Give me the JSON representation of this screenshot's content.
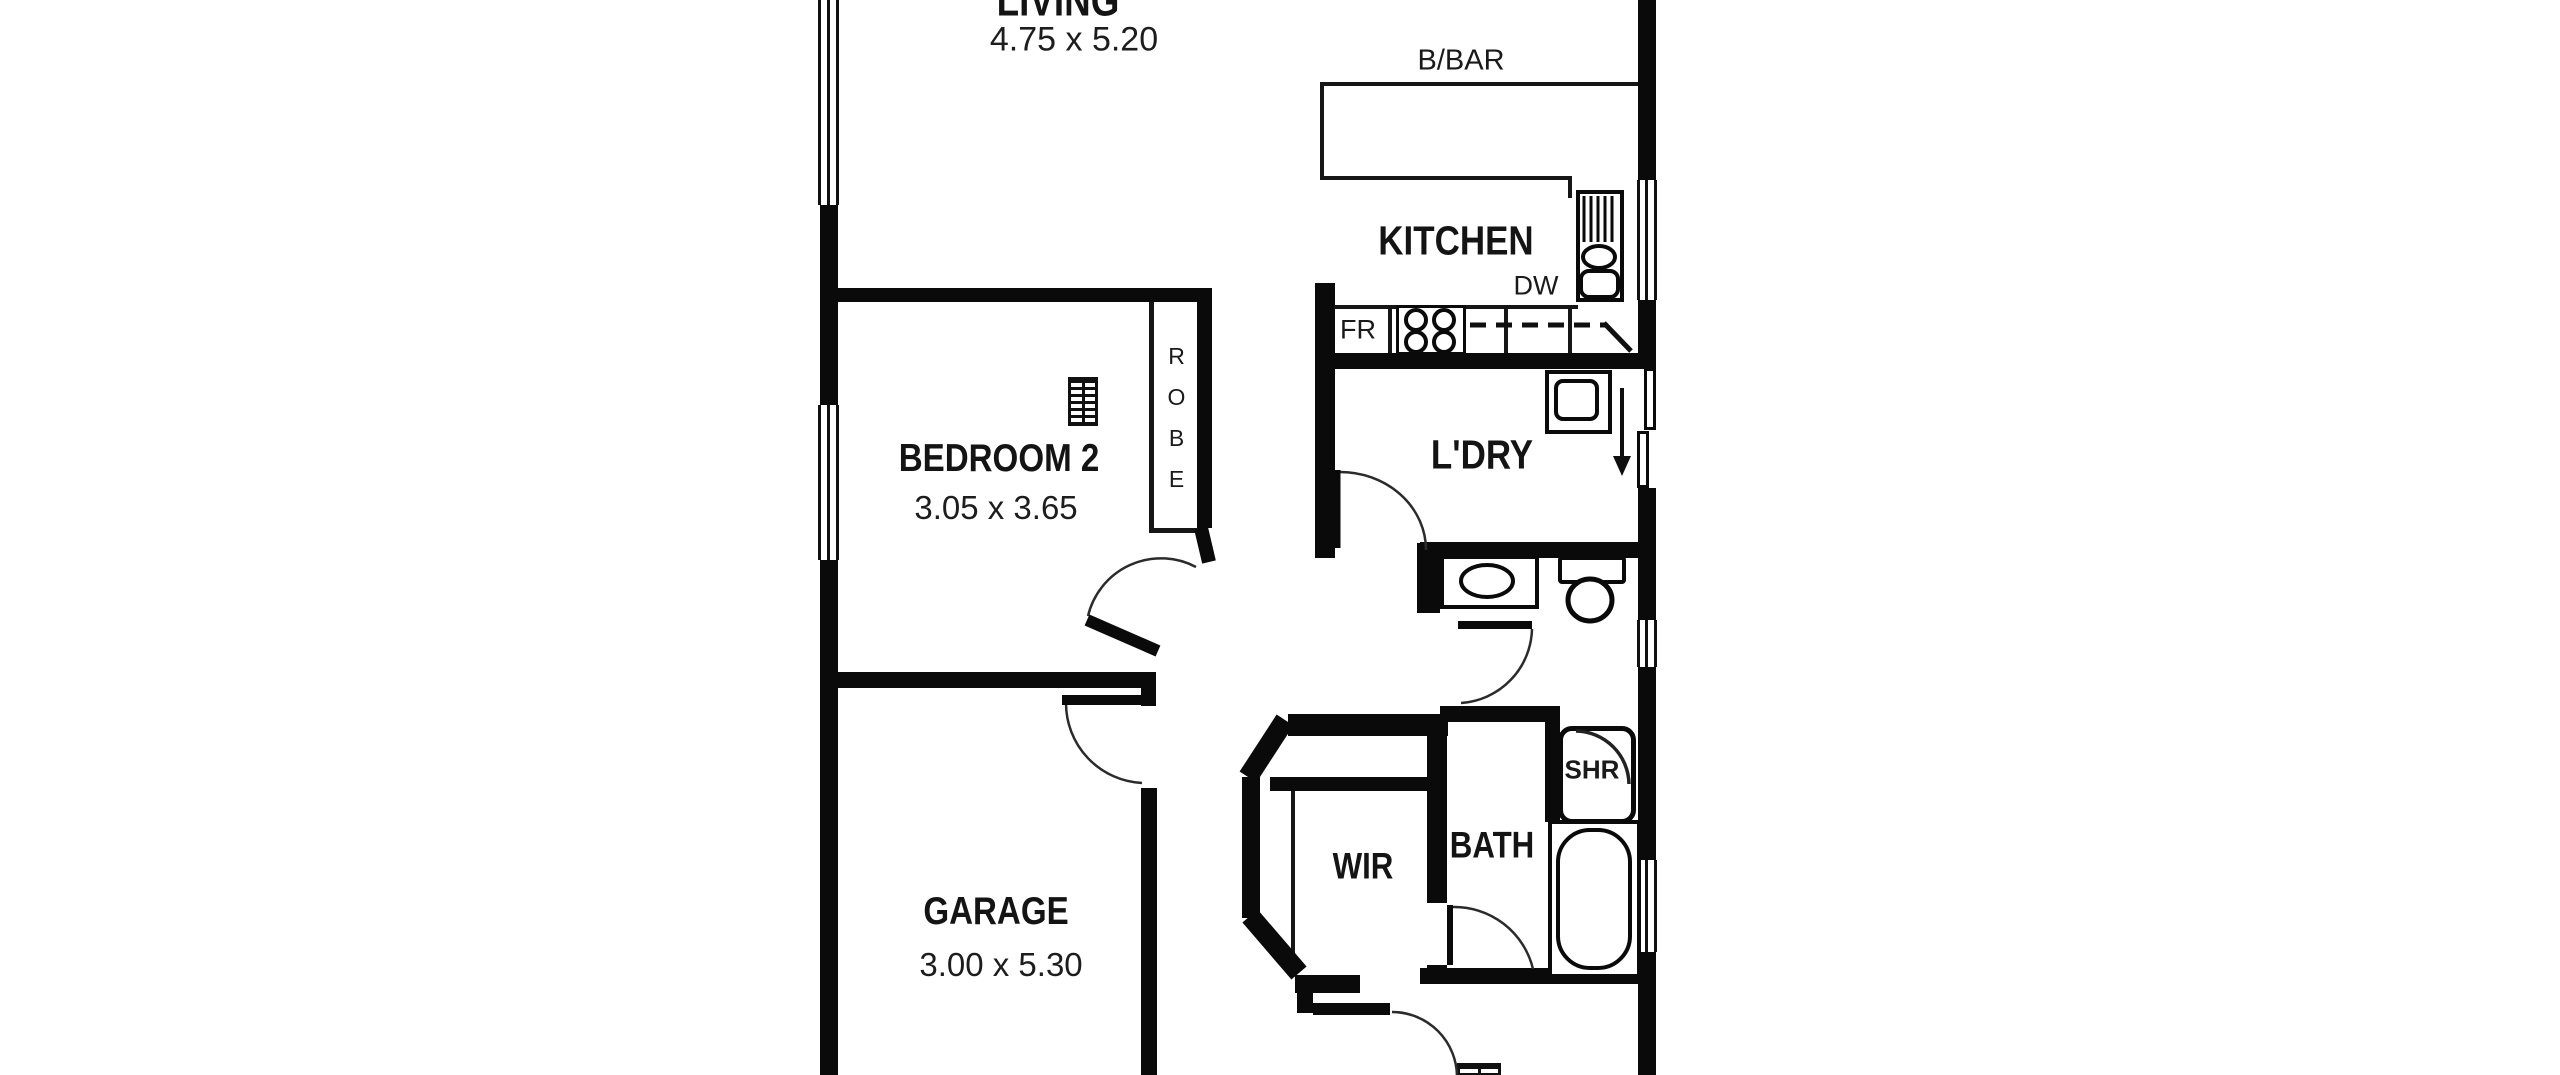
{
  "rooms": {
    "living": {
      "name": "LIVING",
      "dims": "4.75 x 5.20"
    },
    "kitchen": {
      "name": "KITCHEN"
    },
    "bedroom2": {
      "name": "BEDROOM 2",
      "dims": "3.05 x 3.65"
    },
    "laundry": {
      "name": "L'DRY"
    },
    "garage": {
      "name": "GARAGE",
      "dims": "3.00 x 5.30"
    },
    "wir": {
      "name": "WIR"
    },
    "bath": {
      "name": "BATH"
    }
  },
  "fixtures": {
    "breakfast_bar": "B/BAR",
    "fridge": "FR",
    "dishwasher": "DW",
    "robe": "ROBE",
    "shower": "SHR"
  },
  "colors": {
    "wall": "#0a0a0a",
    "background": "#ffffff",
    "text": "#141414"
  }
}
